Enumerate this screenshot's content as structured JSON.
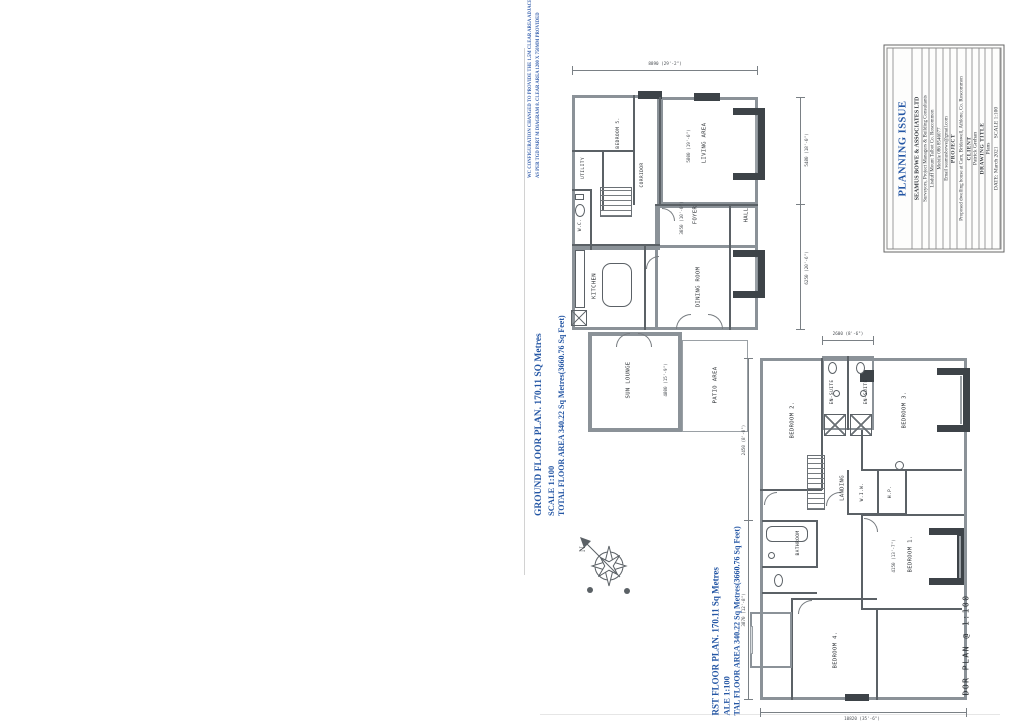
{
  "title_block": {
    "status": "PLANNING ISSUE",
    "firm": "SEAMUS BOWE & ASSOCIATES LTD",
    "firm_sub": "Surveyors, Project Managers & Building Consultants",
    "address": "Lisduff Mount Talbot Co. Roscommon",
    "mobile": "Mobile 086 8546077",
    "email": "Email seamusbowe@gmail.com",
    "project_label": "PROJECT",
    "project": "Proposed dwelling house at Cam, Brideswell, Athlone, Co. Roscommon",
    "client_label": "CLIENT",
    "client": "Patrick Grehan",
    "drawing_title_label": "DRAWING TITLE",
    "drawing_title": "Plans",
    "date_scale": "DATE: March 2021      SCALE 1:100",
    "accent": "#2456a4"
  },
  "note": {
    "line1": "WC CONFIGURATION CHANGED TO PROVIDE THE 1.5M CLEAR AREA ADJACENT TO WC",
    "line2": "AS PER TGD PART M DIAGRAM 8. CLEAR AREA 1200 X 750MM PROVIDED"
  },
  "compass": {
    "north": "N"
  },
  "ground_floor": {
    "caption_line1": "GROUND FLOOR PLAN. 170.11 SQ Metres",
    "caption_line2": "SCALE 1:100",
    "caption_line3": "TOTAL FLOOR AREA 340.22 Sq Metres(3660.76 Sq Feet)",
    "rooms": {
      "living": "LIVING AREA",
      "hall": "HALL",
      "foyer": "FOYER",
      "kitchen": "KITCHEN",
      "dining": "DINING ROOM",
      "sun_lounge": "SUN LOUNGE",
      "patio": "PATIO AREA",
      "utility": "UTILITY",
      "bedroom5": "BEDROOM 5.",
      "corridor": "CORRIDOR",
      "wc": "W.C."
    },
    "dims": {
      "top": "8890 (29'-2\")",
      "right_upper": "5480 (18'-0\")",
      "right_lower": "6250 (20'-6\")",
      "living": "5800 (19'-0\")",
      "foyer": "3050 (10'-0\")",
      "sun_lounge": "4800 (15'-9\")"
    }
  },
  "first_floor": {
    "caption_line1": "RST FLOOR PLAN. 170.11 Sq Metres",
    "caption_line2": "ALE 1:100",
    "caption_line3": "TAL FLOOR AREA 340.22 Sq Metres(3660.76 Sq Feet)",
    "side_label": "DOR PLAN @ 1:100",
    "rooms": {
      "bedroom1": "BEDROOM 1.",
      "bedroom2": "BEDROOM 2.",
      "bedroom3": "BEDROOM 3.",
      "bedroom4": "BEDROOM 4.",
      "landing": "LANDING",
      "bathroom": "BATHROOM",
      "ensuite1": "EN-SUITE",
      "ensuite2": "EN-SUITE",
      "wiw": "W.I.W.",
      "hotpress": "H.P."
    },
    "dims": {
      "left_upper": "2450 (8'-0\")",
      "left_lower": "3870 (12'-8\")",
      "top": "2600 (8'-6\")",
      "bottom": "10820 (35'-6\")",
      "bedroom1": "4150 (13'-7\")"
    }
  }
}
